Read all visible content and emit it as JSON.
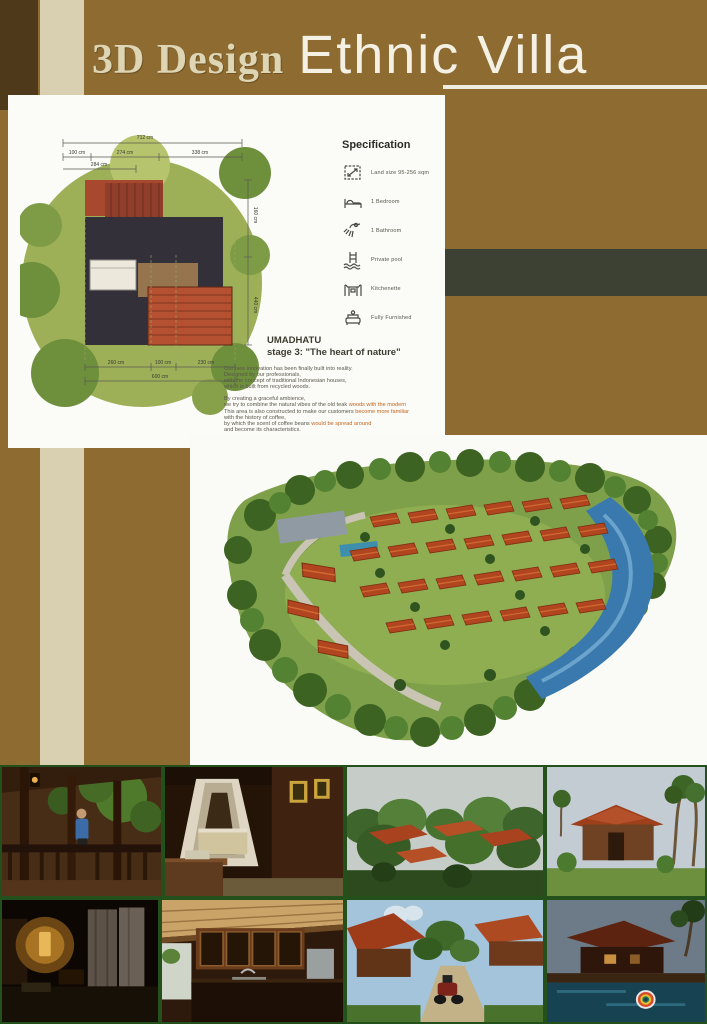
{
  "title": {
    "part1": "3D Design",
    "part2": "Ethnic Villa"
  },
  "colors": {
    "background_brown": "#8d6b31",
    "dark_corner_brown": "#4e3a1b",
    "cream_stripe": "#d9d0b2",
    "olive_band": "#3d4134",
    "title_cream": "#ddd5b4",
    "title_white": "#f4f1e4",
    "highlight_orange": "#c4641f",
    "roof_red": "#b0451f",
    "photo_frame_green": "#23501b"
  },
  "floor_plan": {
    "dims_top_total": "712 cm",
    "dims_top_segments": [
      "100 cm",
      "274 cm",
      "338 cm"
    ],
    "dims_top_inner": "284 cm",
    "dims_bottom_segments": [
      "260 cm",
      "100 cm",
      "230 cm"
    ],
    "dims_bottom_total": "600 cm",
    "dims_right": [
      "160 cm",
      "440 cm"
    ]
  },
  "specification": {
    "title": "Specification",
    "items": [
      {
        "icon": "land-size-icon",
        "label": "Land size 95-256 sqm"
      },
      {
        "icon": "bedroom-icon",
        "label": "1 Bedroom"
      },
      {
        "icon": "bathroom-icon",
        "label": "1 Bathroom"
      },
      {
        "icon": "pool-icon",
        "label": "Private pool"
      },
      {
        "icon": "kitchenette-icon",
        "label": "Kitchenette"
      },
      {
        "icon": "furnished-icon",
        "label": "Fully Furnished"
      }
    ]
  },
  "about": {
    "brand": "UMADHATU",
    "stage": "stage 3: \"The heart of nature\"",
    "paragraph1": [
      "Our new innovation has been finally built into reality.",
      "Designed by our professionals,",
      "with the concept of traditional Indonesian houses,",
      "which is built from recycled woods."
    ],
    "paragraph2": [
      {
        "d": "By creating a graceful ambience,",
        "o": ""
      },
      {
        "d": "we try to combine the natural vibes of the old teak ",
        "o": "woods with the modern"
      },
      {
        "d": "This area is also constructed to make our customers ",
        "o": "become more familiar"
      },
      {
        "d": "with the history of coffee,",
        "o": ""
      },
      {
        "d": "by which the scent of coffee beans ",
        "o": "would be spread around"
      },
      {
        "d": "and become its characteristics.",
        "o": ""
      }
    ]
  },
  "photos": {
    "row1": [
      {
        "name": "terrace-seating"
      },
      {
        "name": "canopy-bedroom"
      },
      {
        "name": "aerial-garden-villas"
      },
      {
        "name": "villa-exterior-palms"
      }
    ],
    "row2": [
      {
        "name": "bedroom-night-lamp"
      },
      {
        "name": "kitchenette-interior"
      },
      {
        "name": "villa-pathway-motorbike"
      },
      {
        "name": "pool-float-dusk"
      }
    ]
  }
}
